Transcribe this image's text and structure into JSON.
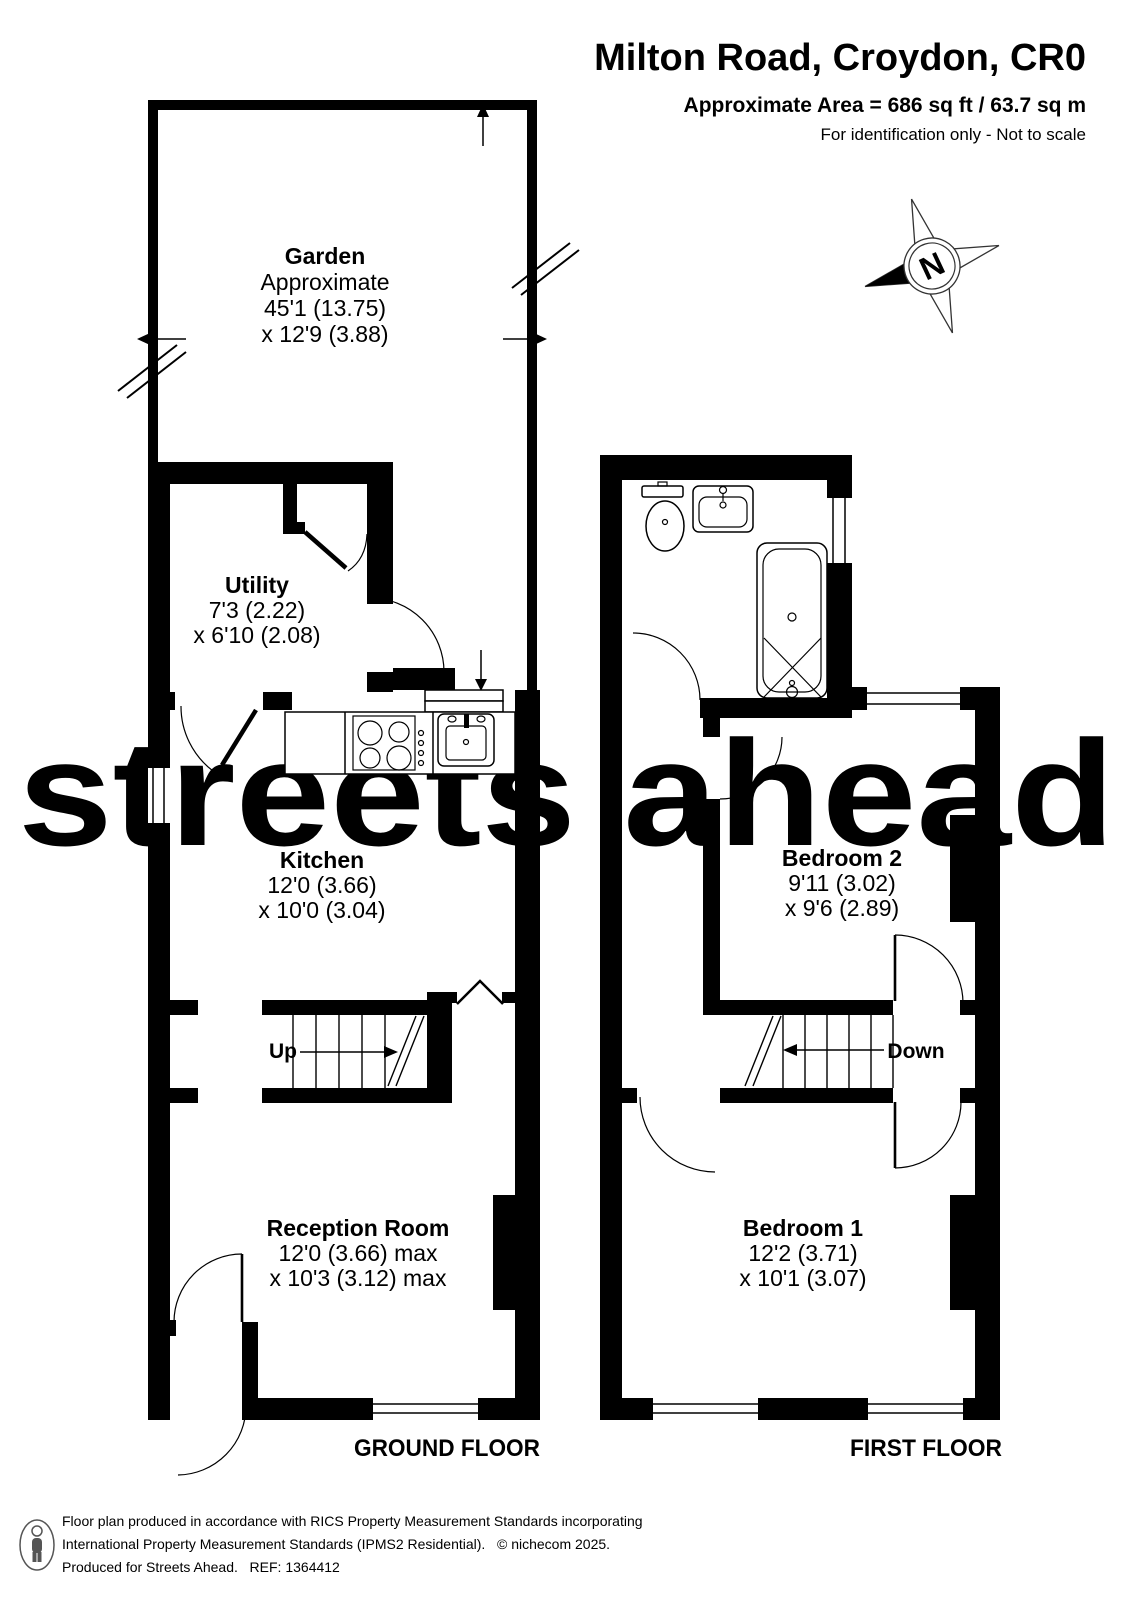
{
  "header": {
    "title": "Milton Road, Croydon, CR0",
    "area": "Approximate Area = 686 sq ft / 63.7 sq m",
    "note": "For identification only - Not to scale"
  },
  "watermark": "streets ahead",
  "compass": {
    "letter": "N"
  },
  "ground_floor": {
    "floor_label": "GROUND FLOOR",
    "stairs_label": "Up",
    "garden": {
      "name": "Garden",
      "line1": "Approximate",
      "line2": "45'1 (13.75)",
      "line3": "x 12'9 (3.88)"
    },
    "utility": {
      "name": "Utility",
      "line1": "7'3 (2.22)",
      "line2": "x 6'10 (2.08)"
    },
    "kitchen": {
      "name": "Kitchen",
      "line1": "12'0 (3.66)",
      "line2": "x 10'0 (3.04)"
    },
    "reception": {
      "name": "Reception Room",
      "line1": "12'0 (3.66) max",
      "line2": "x 10'3 (3.12) max"
    }
  },
  "first_floor": {
    "floor_label": "FIRST FLOOR",
    "stairs_label": "Down",
    "bedroom2": {
      "name": "Bedroom 2",
      "line1": "9'11 (3.02)",
      "line2": "x 9'6 (2.89)"
    },
    "bedroom1": {
      "name": "Bedroom 1",
      "line1": "12'2 (3.71)",
      "line2": "x 10'1 (3.07)"
    }
  },
  "footer": {
    "line1": "Floor plan produced in accordance with RICS Property Measurement Standards incorporating",
    "line2": "International Property Measurement Standards (IPMS2 Residential).   © nichecom 2025.",
    "line3": "Produced for Streets Ahead.   REF: 1364412"
  },
  "colors": {
    "wall": "#000000",
    "watermark": "#dcebc5",
    "footer_text": "#3d3d3d"
  }
}
